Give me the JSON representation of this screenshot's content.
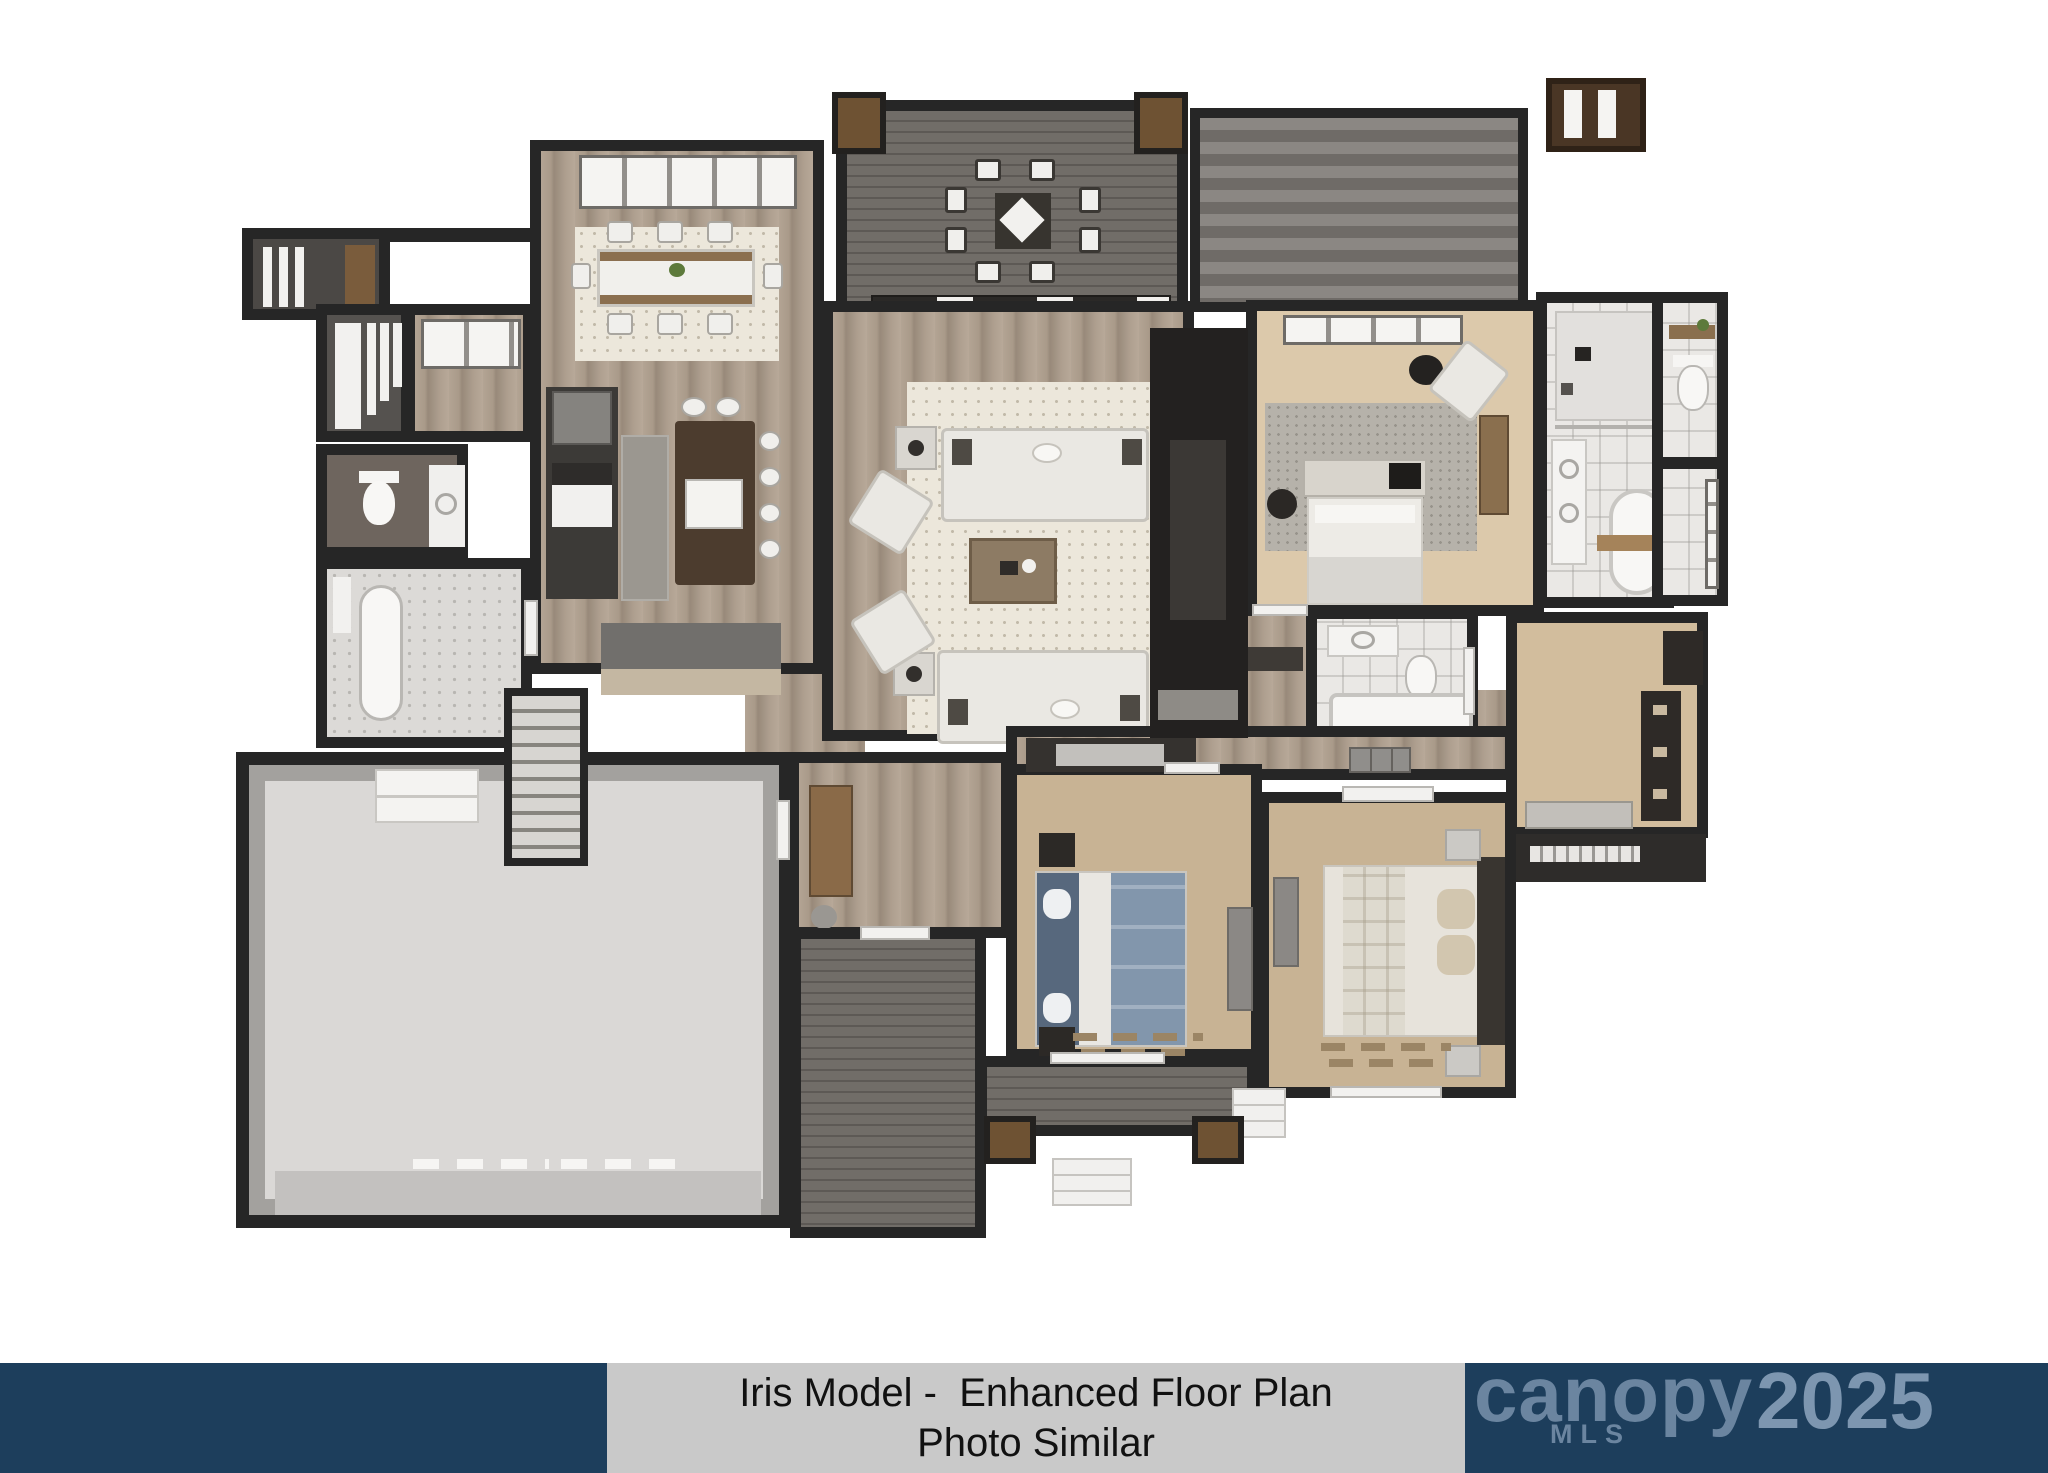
{
  "caption": {
    "line1": "Iris Model -  Enhanced Floor Plan",
    "line2": "Photo Similar",
    "text_color": "#111111",
    "box_color": "#c9c9c9"
  },
  "watermark": {
    "brand": "canopy",
    "sub": "MLS",
    "year": "2025",
    "bar_color": "#1d3e5c",
    "text_color": "#7d98b3"
  },
  "floorplan": {
    "description": "3D rendered top-down floor plan of a single-story home",
    "rooms": [
      "front porch",
      "pantry",
      "flex window nook",
      "powder room",
      "bathroom 3",
      "dining room",
      "kitchen",
      "upper deck",
      "covered porch roof",
      "great room",
      "fireplace wall",
      "staircase",
      "garage",
      "mudroom",
      "rear deck",
      "bedroom 2",
      "bedroom 3",
      "hallway",
      "bathroom 2",
      "master vestibule",
      "master bedroom",
      "master bathroom",
      "water closet",
      "walk-in closet"
    ]
  },
  "palette": {
    "wall": "#262626",
    "wood_floor": "#a99a89",
    "deck": "#68645f",
    "carpet": "#c8b394",
    "tile": "#eae8e5",
    "garage_floor": "#dad8d6",
    "rug": "#ece7db",
    "accent_wood": "#8a6a48",
    "background": "#ffffff"
  }
}
